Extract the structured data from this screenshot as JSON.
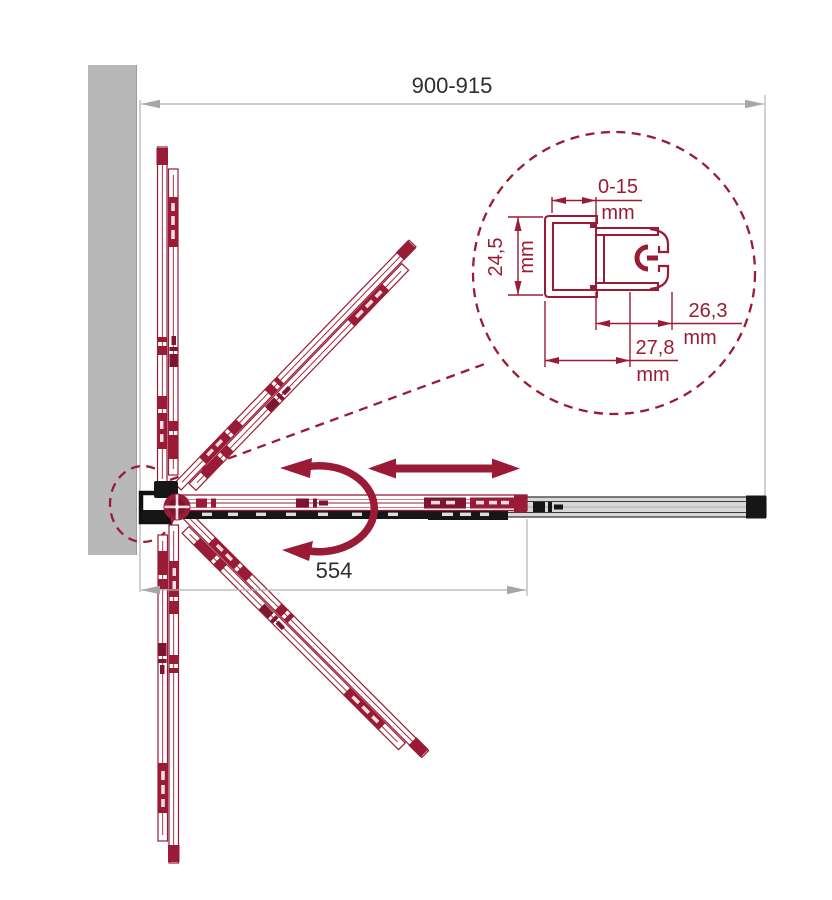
{
  "diagram": {
    "title": "folding-shower-door-top-view-technical-drawing",
    "dim_overall": "900-915",
    "dim_open": "554",
    "detail": {
      "gap": {
        "value": "0-15",
        "unit": "mm"
      },
      "depth": {
        "value": "24,5",
        "unit": "mm"
      },
      "inner": {
        "value": "26,3",
        "unit": "mm"
      },
      "outer": {
        "value": "27,8",
        "unit": "mm"
      }
    },
    "icons": {
      "rotation_arrow": "curved-double-arrow",
      "slide_arrow": "horizontal-double-arrow"
    },
    "colors": {
      "panel_maroon": "#9a1b35",
      "panel_dark": "#7e1530",
      "wall_gray": "#b8b8b8",
      "rail_gray": "#d8d8d8",
      "hardware_black": "#161616",
      "dimension_gray": "#aeaeae",
      "label_text": "#2e2e2e"
    }
  }
}
